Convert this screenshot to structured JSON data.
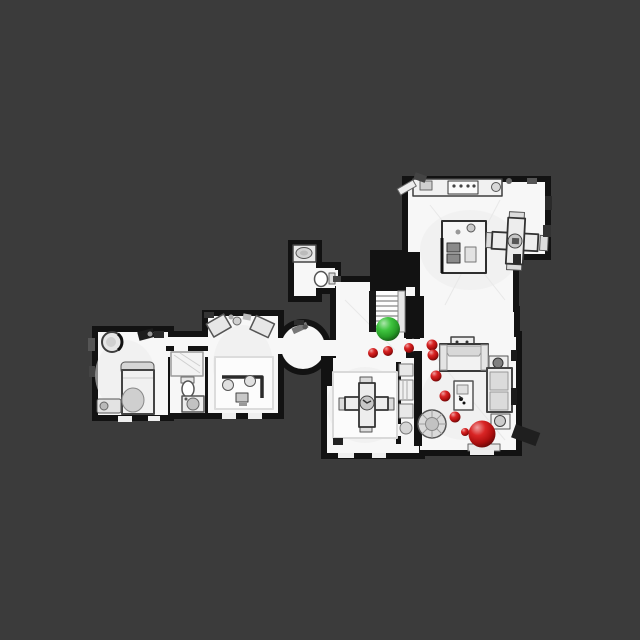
{
  "viewer": {
    "background_color": "#3b3b3b",
    "floor_color": "#f7f7f7",
    "wall_color": "#121212"
  },
  "markers": {
    "start": {
      "name": "start-position",
      "x": 388,
      "y": 329,
      "r": 12,
      "color": "#2fc02f"
    },
    "goal": {
      "name": "goal-position",
      "x": 482,
      "y": 434,
      "r": 13.5,
      "color": "#d61212"
    },
    "waypoints": {
      "name": "path-waypoints",
      "color": "#d61212",
      "points": [
        {
          "x": 373,
          "y": 353,
          "r": 5
        },
        {
          "x": 388,
          "y": 351,
          "r": 5
        },
        {
          "x": 409,
          "y": 348,
          "r": 5
        },
        {
          "x": 432,
          "y": 345,
          "r": 5.5
        },
        {
          "x": 433,
          "y": 355,
          "r": 5.5
        },
        {
          "x": 436,
          "y": 376,
          "r": 5.5
        },
        {
          "x": 445,
          "y": 396,
          "r": 5.5
        },
        {
          "x": 455,
          "y": 417,
          "r": 5.5
        },
        {
          "x": 465,
          "y": 432,
          "r": 4
        }
      ]
    }
  }
}
